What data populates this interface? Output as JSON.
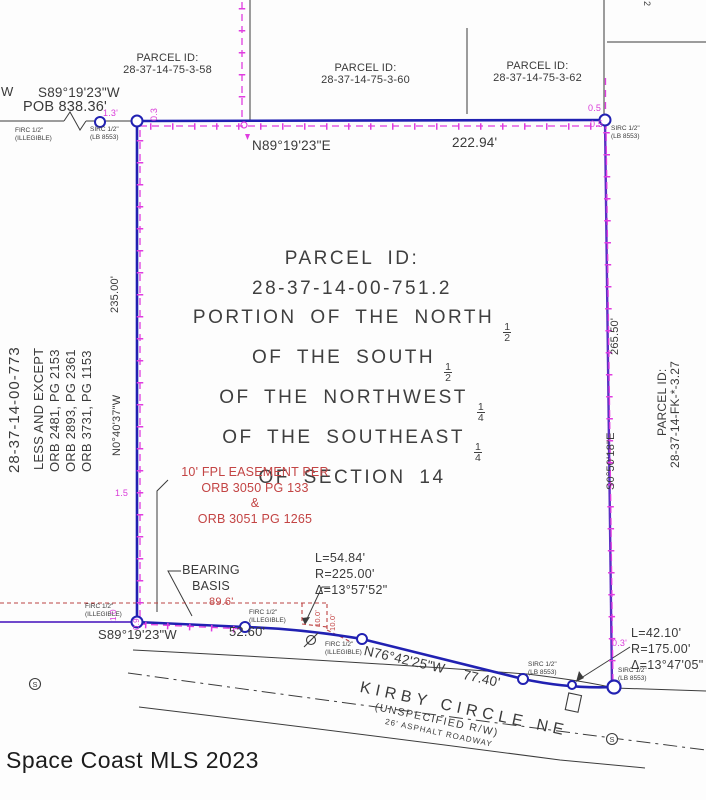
{
  "watermark": "Space Coast MLS 2023",
  "colors": {
    "boundary_blue": "#2121b2",
    "fence_magenta": "#d93cd9",
    "easement_red": "#c34444",
    "east_overlap_purple": "#5b2fc4",
    "linework_black": "#3c3c3c"
  },
  "adjacent_parcels": {
    "nw": {
      "title": "PARCEL ID:",
      "id": "28-37-14-75-3-58"
    },
    "north": {
      "title": "PARCEL ID:",
      "id": "28-37-14-75-3-60"
    },
    "ne": {
      "title": "PARCEL ID:",
      "id": "28-37-14-75-3-62"
    },
    "west_id": "28-37-14-00-773",
    "east": {
      "title": "PARCEL ID:",
      "id": "28-37-14-FK-*-3.27"
    }
  },
  "subject_parcel": {
    "title": "PARCEL ID:",
    "id": "28-37-14-00-751.2",
    "desc_line1": "PORTION OF THE NORTH",
    "desc_line2": "OF THE SOUTH",
    "desc_line3": "OF THE NORTHWEST",
    "desc_line4": "OF THE SOUTHEAST",
    "desc_line5": "OF SECTION 14",
    "frac_half_num": "1",
    "frac_half_den": "2",
    "frac_quarter_num": "1",
    "frac_quarter_den": "4"
  },
  "less_and_except": {
    "title": "LESS AND EXCEPT",
    "orb1": "ORB 2481, PG 2153",
    "orb2": "ORB 2893, PG 2361",
    "orb3": "ORB 3731, PG 1153"
  },
  "easement": {
    "l1": "10' FPL EASEMENT PER",
    "l2": "ORB 3050 PG 133",
    "l3": "&",
    "l4": "ORB 3051 PG 1265",
    "width1": "10.0'",
    "width2": "10.0'",
    "length": "89.6'"
  },
  "boundary": {
    "tie_w": "W",
    "tie_bearing": "S89°19'23\"W",
    "tie_pob": "POB 838.36'",
    "north_bearing": "N89°19'23\"E",
    "north_dist": "222.94'",
    "west_bearing": "N0°40'37\"W",
    "west_dist": "235.00'",
    "east_bearing": "S0°50'18\"E",
    "east_dist": "265.50'",
    "south_bearing": "S89°19'23\"W",
    "south_dist": "52.60'",
    "southeast_bearing": "N76°42'25\"W",
    "southeast_dist": "77.40'",
    "bearing_basis_1": "BEARING",
    "bearing_basis_2": "BASIS"
  },
  "curves": {
    "c1_l": "L=54.84'",
    "c1_r": "R=225.00'",
    "c1_delta": "Δ=13°57'52\"",
    "c2_l": "L=42.10'",
    "c2_r": "R=175.00'",
    "c2_delta": "Δ=13°47'05\""
  },
  "monuments": {
    "firc_1": "FIRC 1/2\"",
    "firc_2": "(ILLEGIBLE)",
    "sirc_1": "SIRC 1/2\"",
    "sirc_2": "(LB 8553)"
  },
  "fence_offsets": {
    "tl": "1.3'",
    "tl_v": "0.3",
    "tr_a": "0.5",
    "tr_b": "0.5",
    "w": "1.5",
    "bl_a": "1.0",
    "bl_b": "0.9",
    "br": "0.3'",
    "stray": "2"
  },
  "road": {
    "name": "KIRBY CIRCLE NE",
    "rw": "(UNSPECIFIED R/W)",
    "surface": "26' ASPHALT ROADWAY",
    "manhole": "S"
  }
}
